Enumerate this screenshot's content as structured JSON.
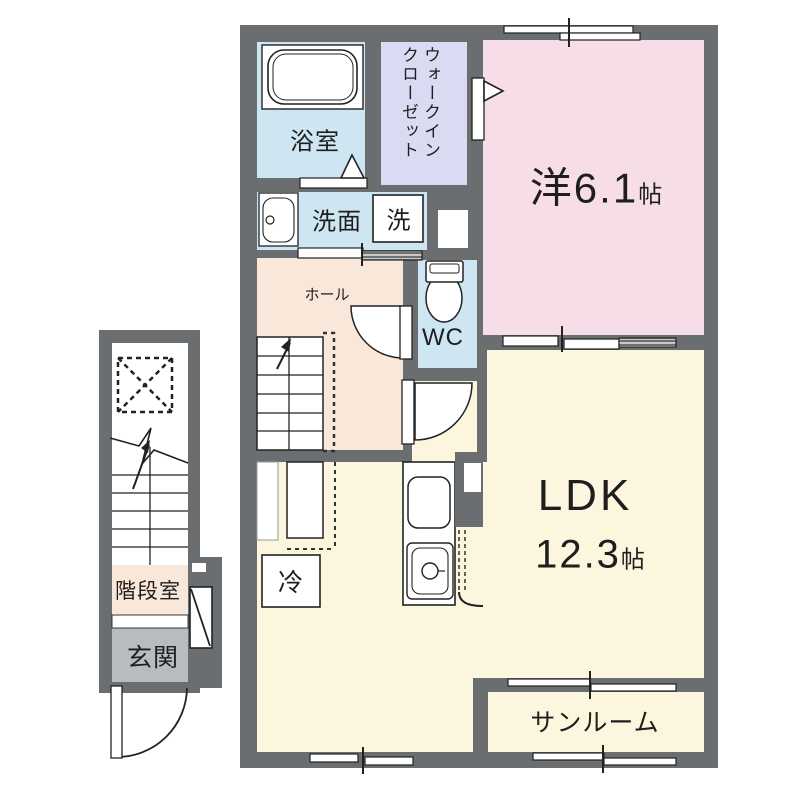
{
  "plan": {
    "type": "floor-plan",
    "rooms": {
      "bathroom": {
        "label": "浴室"
      },
      "walk_in_closet": {
        "line1": "ウォークイン",
        "line2": "クローゼット"
      },
      "washroom": {
        "label": "洗面"
      },
      "washing_machine": {
        "label": "洗"
      },
      "western_room": {
        "label": "洋6.1",
        "unit": "帖"
      },
      "wc": {
        "label": "WC"
      },
      "hall": {
        "label": "ホール"
      },
      "ldk": {
        "label": "LDK",
        "size": "12.3",
        "unit": "帖"
      },
      "refrigerator": {
        "label": "冷"
      },
      "sunroom": {
        "label": "サンルーム"
      },
      "stair_room": {
        "label": "階段室"
      },
      "entrance": {
        "label": "玄関"
      }
    },
    "colors": {
      "wall": "#6b6e70",
      "water_blue": "#cee6f2",
      "closet_lavender": "#d9dbf2",
      "bedroom_pink": "#f6dde7",
      "hall_peach": "#f9e7d9",
      "ldk_cream": "#fbf6dd",
      "entrance_gray": "#b9bcbf"
    }
  }
}
